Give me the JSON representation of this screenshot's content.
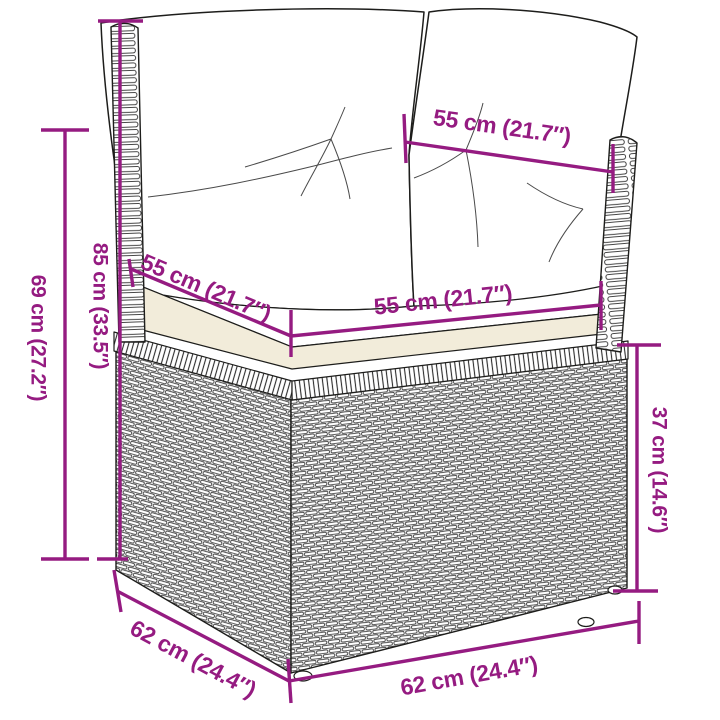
{
  "diagram": {
    "type": "product-dimension-diagram",
    "subject": "poly rattan corner sofa section with white cushions",
    "accent_color": "#951B81",
    "art_color": "#1D1D1B",
    "measurements": {
      "back_top_width": {
        "label": "55 cm (21.7″)"
      },
      "seat_depth_left": {
        "label": "55 cm (21.7″)"
      },
      "seat_width_front": {
        "label": "55 cm (21.7″)"
      },
      "overall_height": {
        "label": "85 cm (33.5″)"
      },
      "arm_height": {
        "label": "69 cm (27.2″)"
      },
      "base_height": {
        "label": "37 cm (14.6″)"
      },
      "depth_left": {
        "label": "62 cm (24.4″)"
      },
      "width_front": {
        "label": "62 cm (24.4″)"
      }
    }
  }
}
